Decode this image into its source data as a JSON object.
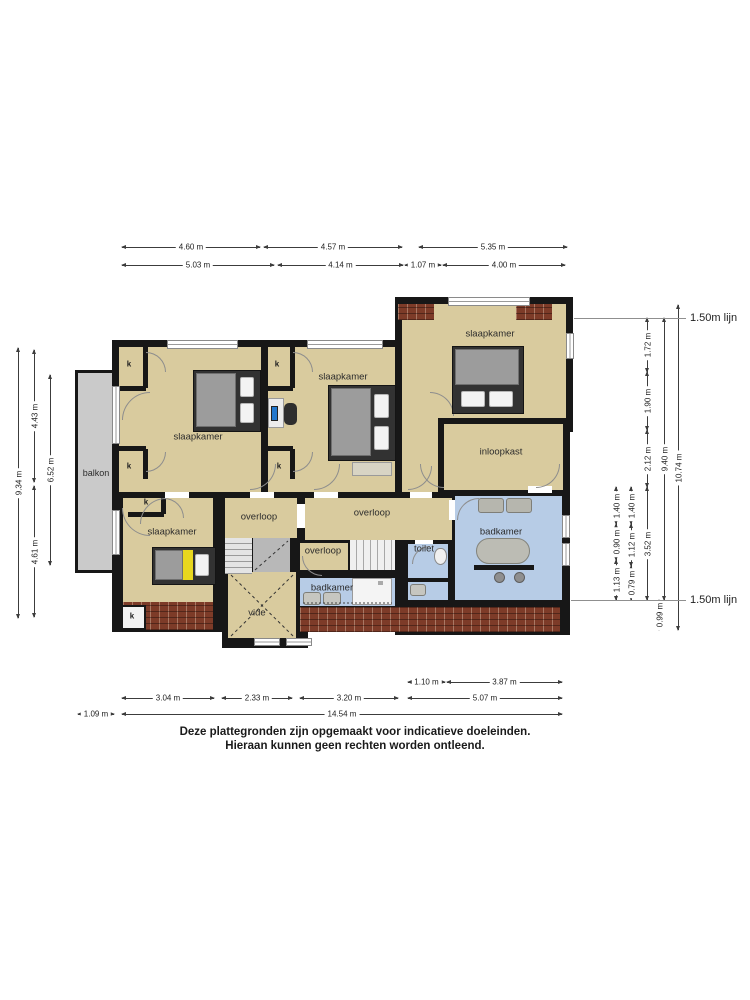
{
  "rooms": {
    "slaapkamer_tl": "slaapkamer",
    "slaapkamer_tm": "slaapkamer",
    "slaapkamer_tr": "slaapkamer",
    "slaapkamer_bl": "slaapkamer",
    "inloopkast": "inloopkast",
    "overloop_left": "overloop",
    "overloop_mid": "overloop",
    "overloop_small": "overloop",
    "vide": "vide",
    "toilet": "toilet",
    "badkamer_small": "badkamer",
    "badkamer_large": "badkamer",
    "balkon": "balkon",
    "kast": "k"
  },
  "dims": {
    "top1": [
      "4.60 m",
      "4.57 m",
      "5.35 m"
    ],
    "top2": [
      "5.03 m",
      "4.14 m",
      "1.07 m",
      "4.00 m"
    ],
    "left": [
      "9.34 m",
      "4.43 m",
      "4.61 m",
      "6.52 m"
    ],
    "right_inner1": [
      "1.40 m",
      "0.90 m",
      "1.13 m"
    ],
    "right_inner2": [
      "1.40 m",
      "1.12 m",
      "0.79 m"
    ],
    "right_main": [
      "1.72 m",
      "1.90 m",
      "2.12 m",
      "3.52 m",
      "0.99 m"
    ],
    "right_total": [
      "9.40 m",
      "10.74 m"
    ],
    "bottom1": [
      "1.10 m",
      "3.87 m"
    ],
    "bottom2": [
      "3.04 m",
      "2.33 m",
      "3.20 m",
      "5.07 m"
    ],
    "bottom3": [
      "1.09 m",
      "14.54 m"
    ],
    "lijn_top": "1.50m lijn",
    "lijn_bottom": "1.50m lijn"
  },
  "disclaimer": {
    "line1": "Deze plattegronden zijn opgemaakt voor indicatieve doeleinden.",
    "line2": "Hieraan kunnen geen rechten worden ontleend."
  },
  "colors": {
    "room_fill": "#d9cb9e",
    "wet_room_fill": "#b7cce6",
    "wall": "#171717",
    "balcony_fill": "#cacaca",
    "brick": "#7d3b28",
    "bed_accent_yellow": "#e8d71e"
  }
}
